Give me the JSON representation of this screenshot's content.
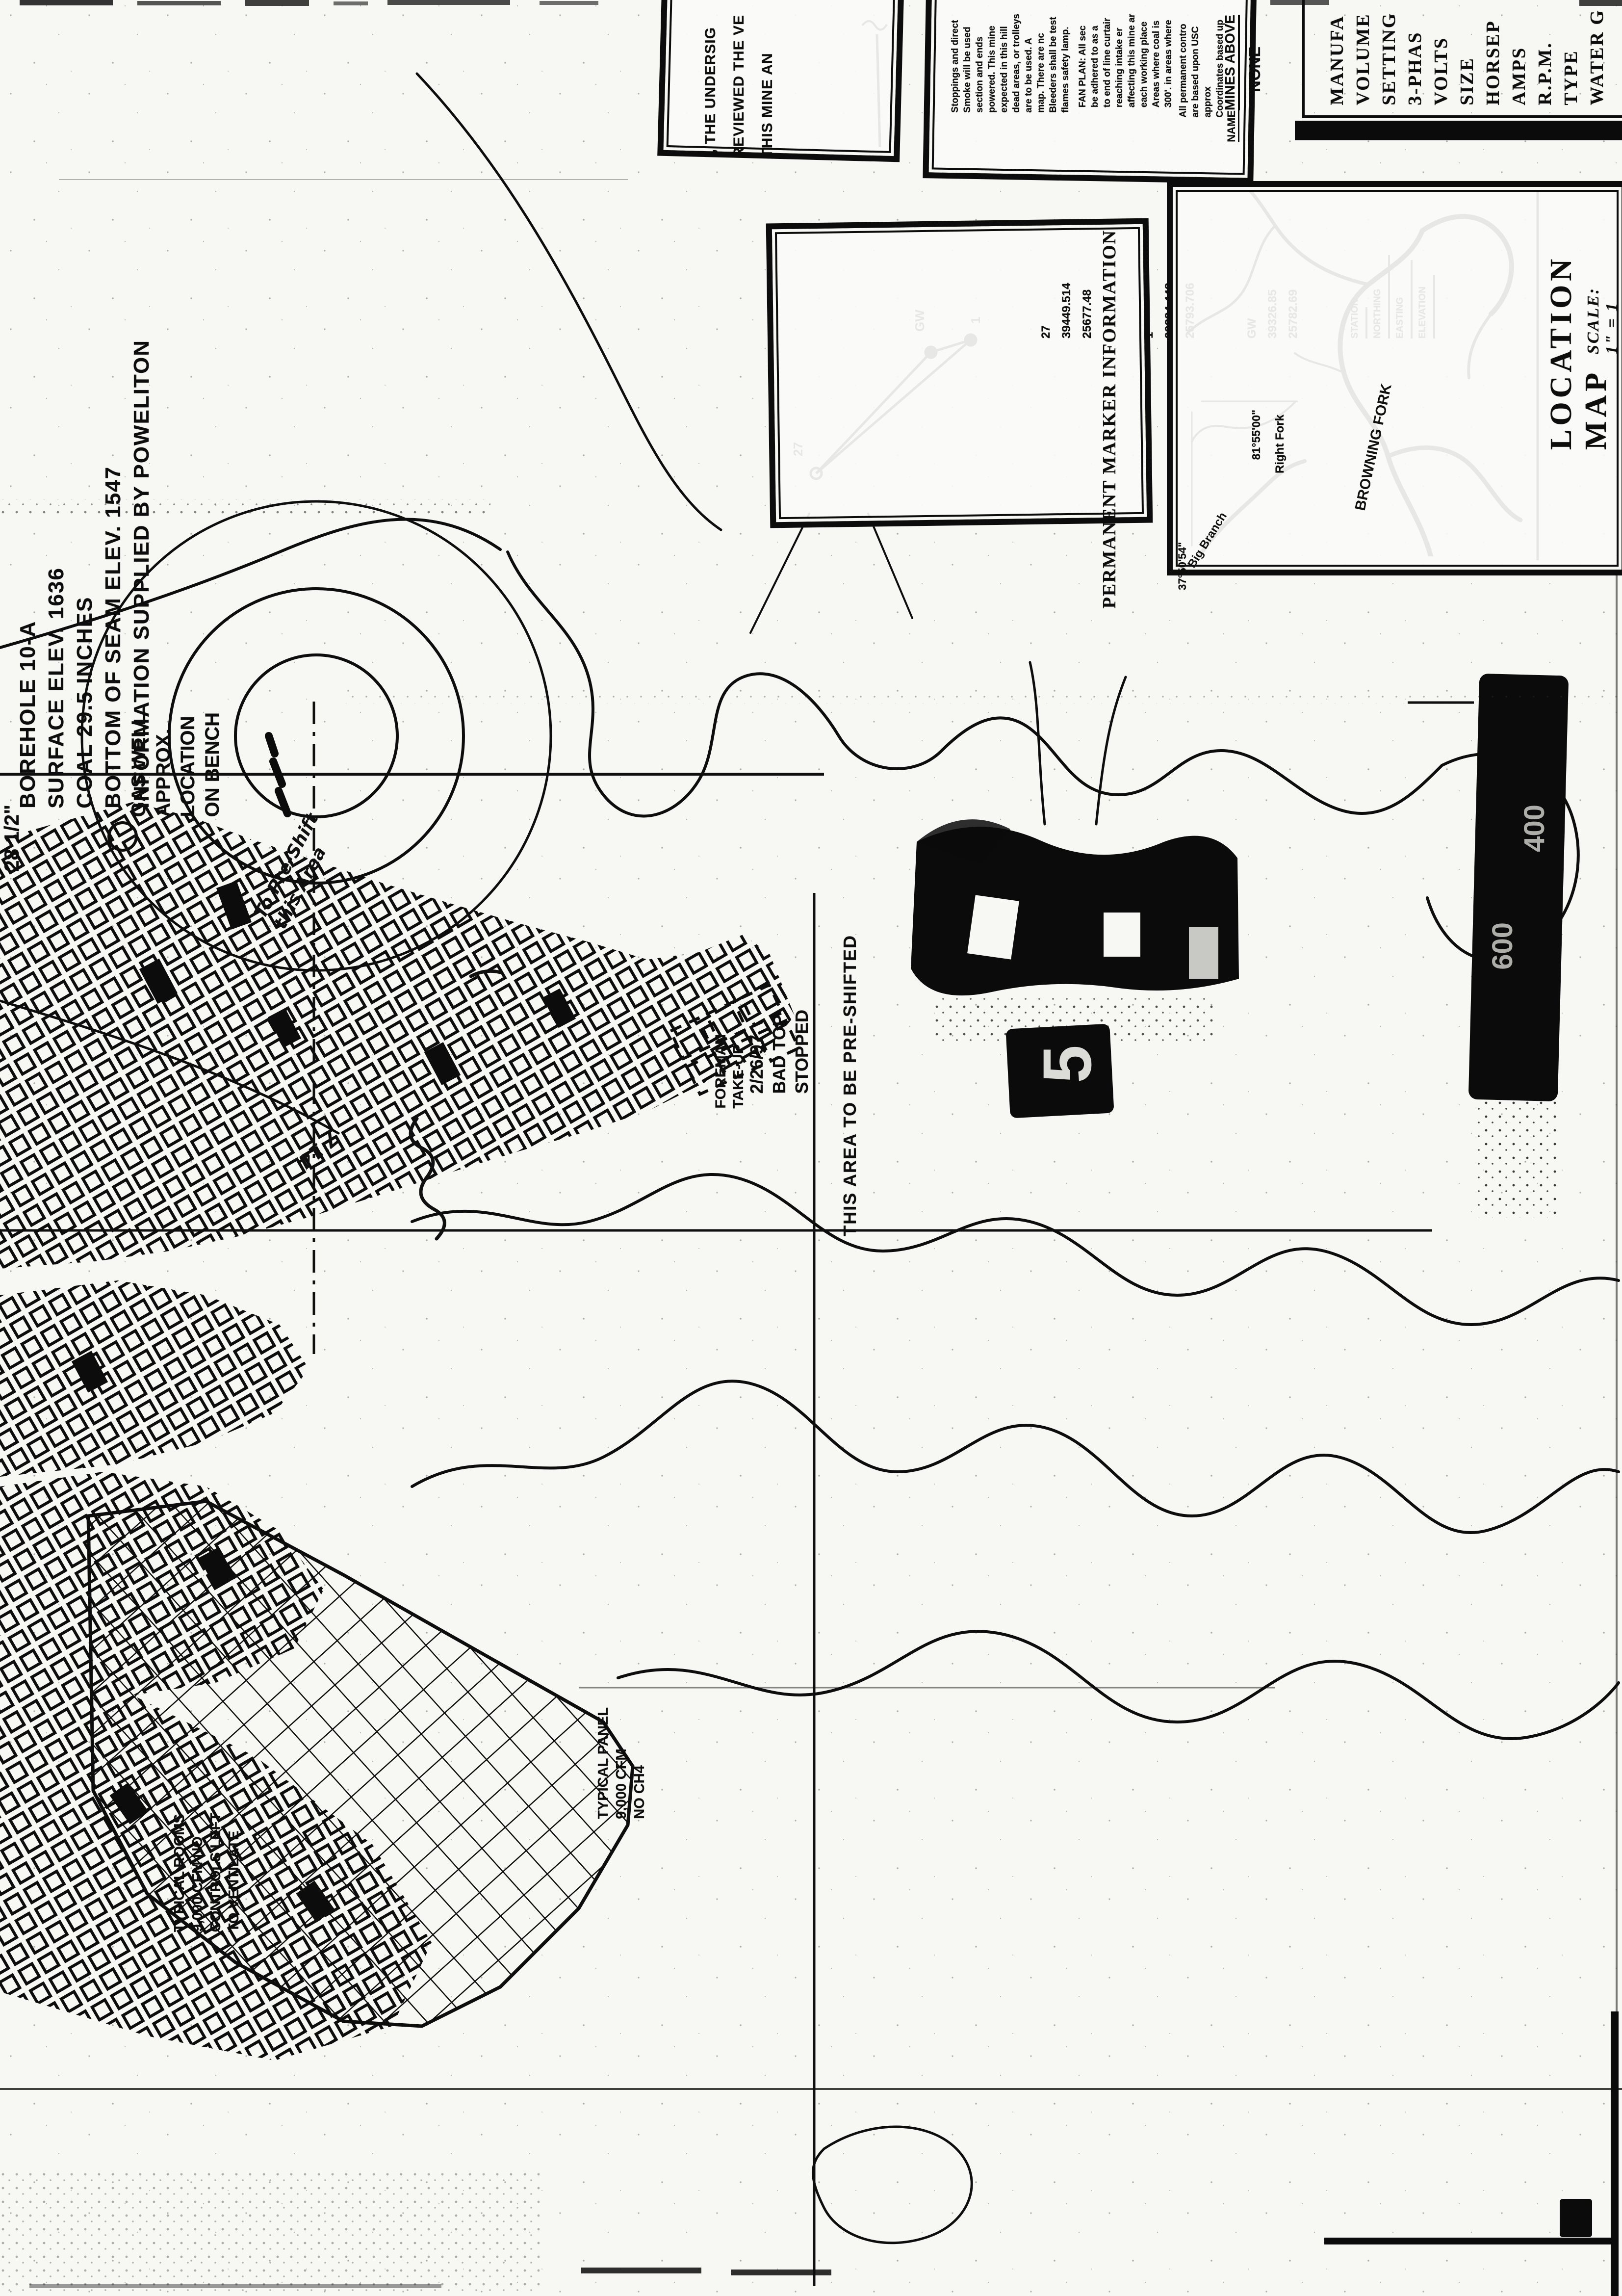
{
  "annotations": {
    "coal_thickness": "28 1/2\"",
    "borehole_note": [
      "BOREHOLE 10-A",
      "SURFACE ELEV. 1636",
      "COAL 29.5 INCHES",
      "BOTTOM OF SEAM ELEV. 1547",
      "INFORMATION SUPPLIED BY POWELITON"
    ],
    "gas_well_note": [
      "GAS WELL",
      "APPROX.",
      "LOCATION",
      "ON BENCH"
    ],
    "handwritten_preshift": [
      "To Pre-Shift",
      "this Area"
    ],
    "preshift_note": "THIS AREA TO BE PRE-SHIFTED",
    "date_note": [
      "2/26/97",
      "BAD TOP",
      "STOPPED"
    ],
    "foreman_note": [
      "FOREMAN",
      "TAKE-UP"
    ],
    "handwritten_mark": "7'14",
    "typical_panel_note": [
      "TYPICAL PANEL",
      "9,000 CFM",
      "NO CH4"
    ],
    "typical_rooms_note": [
      "TYPICAL ROOMS",
      "9,000 CFM NO",
      "CONTROLS LEFT",
      "TO VENTILATE"
    ],
    "sheet_number": "5",
    "shaft_labels": [
      "600",
      "400"
    ]
  },
  "header": {
    "certification_box": {
      "lines": [
        "I, THE UNDERSIG",
        "REVIEWED THE VE",
        "THIS MINE AN"
      ]
    },
    "ventilation_box": {
      "para1": [
        "Stoppings and direct",
        "Smoke will be used",
        "section and ends",
        "powered.  This mine",
        "expected in this hill",
        "dead areas, or trolleys",
        "are to be used.  A",
        "map.  There are nc",
        "Bleeders shall be test",
        "flames safety lamp."
      ],
      "para2": [
        "FAN PLAN:  All sec",
        "be adhered to as a",
        "to end of line curtair",
        "reaching intake er",
        "affecting this mine ar",
        "each working place",
        "Areas where coal is",
        "300'.  in areas where"
      ],
      "para3": [
        "All permanent contro",
        "are based upon USC",
        "approx",
        "Coordinates based up"
      ],
      "name_label": "NAME",
      "mines_above_label": "MINES ABOVE",
      "mines_above_value": "NONE"
    },
    "fan_panel": {
      "lines": [
        "MANUFA",
        "VOLUME",
        "SETTING",
        "3-PHAS",
        "VOLTS",
        "SIZE",
        "HORSEP",
        "AMPS",
        "R.P.M.",
        "TYPE",
        "WATER G"
      ]
    }
  },
  "marker_box": {
    "title": "PERMANENT MARKER INFORMATION",
    "columns": [
      "STATION",
      "NORTHING",
      "EASTING",
      "ELEVATION"
    ],
    "rows": [
      [
        "GW",
        "39326.85",
        "25782.69"
      ],
      [
        "1",
        "39284.448",
        "25793.706"
      ],
      [
        "27",
        "39449.514",
        "25677.48"
      ]
    ],
    "points": {
      "p27": "27",
      "pgw": "GW",
      "p1": "1"
    }
  },
  "location_map": {
    "title": "LOCATION MAP",
    "scale": "SCALE: 1\" = 1 MILE",
    "labels": {
      "stream": "BROWNING FORK",
      "right_fork": "Right Fork",
      "longitude": "81°55'00\"",
      "latitude": "37°50'54\"",
      "branch": "Big Branch"
    }
  }
}
